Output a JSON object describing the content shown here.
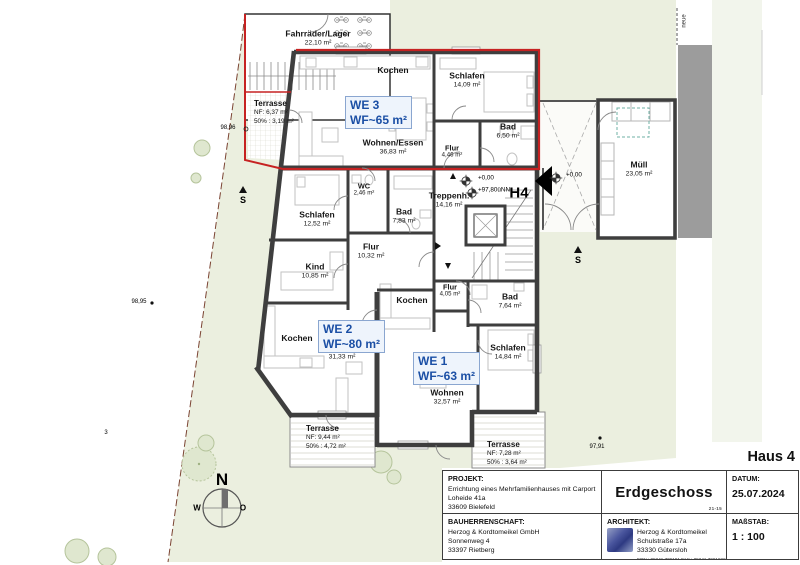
{
  "units": [
    {
      "id": "WE 3",
      "wf": "WF~65 m²"
    },
    {
      "id": "WE 2",
      "wf": "WF~80 m²"
    },
    {
      "id": "WE 1",
      "wf": "WF~63 m²"
    }
  ],
  "rooms": [
    {
      "name": "Fahrräder/Lager",
      "area": "22,10 m²"
    },
    {
      "name": "Kochen",
      "area": ""
    },
    {
      "name": "Schlafen",
      "area": "14,09 m²"
    },
    {
      "name": "Bad",
      "area": "6,50 m²"
    },
    {
      "name": "Wohnen/Essen",
      "area": "36,83 m²"
    },
    {
      "name": "Flur",
      "area": "4,46 m²"
    },
    {
      "name": "WC",
      "area": "2,46 m²"
    },
    {
      "name": "Treppenh.",
      "area": "14,16 m²"
    },
    {
      "name": "Bad",
      "area": "7,83 m²"
    },
    {
      "name": "Schlafen",
      "area": "12,52 m²"
    },
    {
      "name": "Flur",
      "area": "10,32 m²"
    },
    {
      "name": "Kind",
      "area": "10,85 m²"
    },
    {
      "name": "Flur",
      "area": "4,05 m²"
    },
    {
      "name": "Kochen",
      "area": ""
    },
    {
      "name": "Bad",
      "area": "7,64 m²"
    },
    {
      "name": "Kochen",
      "area": ""
    },
    {
      "name": "Wohnen",
      "area": "31,33 m²"
    },
    {
      "name": "Schlafen",
      "area": "14,84 m²"
    },
    {
      "name": "Wohnen",
      "area": "32,57 m²"
    },
    {
      "name": "Müll",
      "area": "23,05 m²"
    }
  ],
  "terraces": [
    {
      "name": "Terrasse",
      "nf": "NF:   6,37 m²",
      "half": "50% : 3,19 m²"
    },
    {
      "name": "Terrasse",
      "nf": "NF:   9,44 m²",
      "half": "50% : 4,72 m²"
    },
    {
      "name": "Terrasse",
      "nf": "NF:   7,28 m²",
      "half": "50% : 3,64 m²"
    }
  ],
  "markers": {
    "h4": "H4",
    "level_zero": "+0,00",
    "level_nn": "+97,80üNN",
    "level_zero2": "+0,00",
    "s": "S",
    "neue": "neue",
    "p9896": "98,96",
    "p9895": "98,95",
    "p9791": "97,91",
    "p3": "3"
  },
  "compass": {
    "n": "N",
    "w": "W",
    "o": "O"
  },
  "titleblock": {
    "haus": "Haus 4",
    "projekt_label": "PROJEKT:",
    "projekt_lines": [
      "Errichtung eines Mehrfamilienhauses mit Carport",
      "Loheide 41a",
      "33609 Bielefeld"
    ],
    "plan_title": "Erdgeschoss",
    "note": "21-15",
    "datum_label": "DATUM:",
    "datum": "25.07.2024",
    "bauherr_label": "BAUHERRENSCHAFT:",
    "bauherr_lines": [
      "Herzog & Kordtomeikel GmbH",
      "Sonnenweg 4",
      "33397 Rietberg"
    ],
    "architekt_label": "ARCHITEKT:",
    "architekt_lines": [
      "Herzog & Kordtomeikel",
      "Schulstraße 17a",
      "33330 Gütersloh"
    ],
    "architekt_fon": "FON.: 05241 709191   FAX.: 05241 7091929",
    "massstab_label": "MAßSTAB:",
    "massstab": "1 : 100"
  },
  "colors": {
    "wall": "#3e3e3e",
    "unit_red": "#c62222",
    "label_blue": "#1b4fa5",
    "site_green": "#ebefdf"
  }
}
